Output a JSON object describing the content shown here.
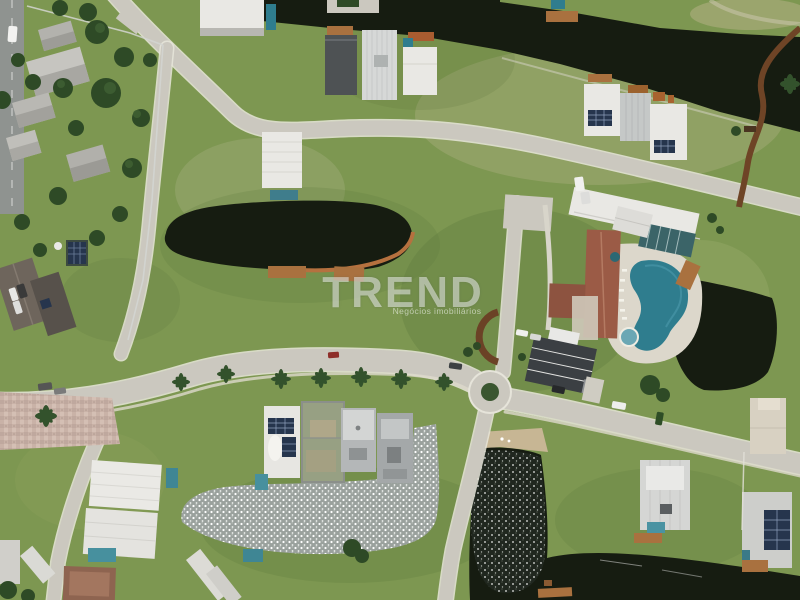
{
  "watermark": {
    "brand": "TREND",
    "tagline": "Negócios imobiliários"
  },
  "scene": {
    "description": "Aerial drone view of a lakeside residential condominium",
    "features": [
      "perimeter canal",
      "central pond",
      "sun-glint lakes",
      "clubhouse with kidney pool",
      "roundabout",
      "palm-lined avenue",
      "houses under construction",
      "solar rooftops"
    ]
  },
  "palette": {
    "grass": "#7d9751",
    "grass_light": "#a3ad7a",
    "grass_dark": "#5e7a3e",
    "water_dark": "#161c11",
    "water_sparkle_base": "#9aa19d",
    "road": "#cbc8bf",
    "road_asphalt": "#8f9390",
    "paver": "#c9b2a7",
    "roof_white": "#e9e8e4",
    "roof_gray": "#a7abac",
    "roof_dark": "#3b3f43",
    "roof_red": "#9b5b46",
    "wood_deck": "#a9713f",
    "pool_teal": "#2f7d8e",
    "solar_panel": "#26354d",
    "tree": "#2e4a26"
  }
}
